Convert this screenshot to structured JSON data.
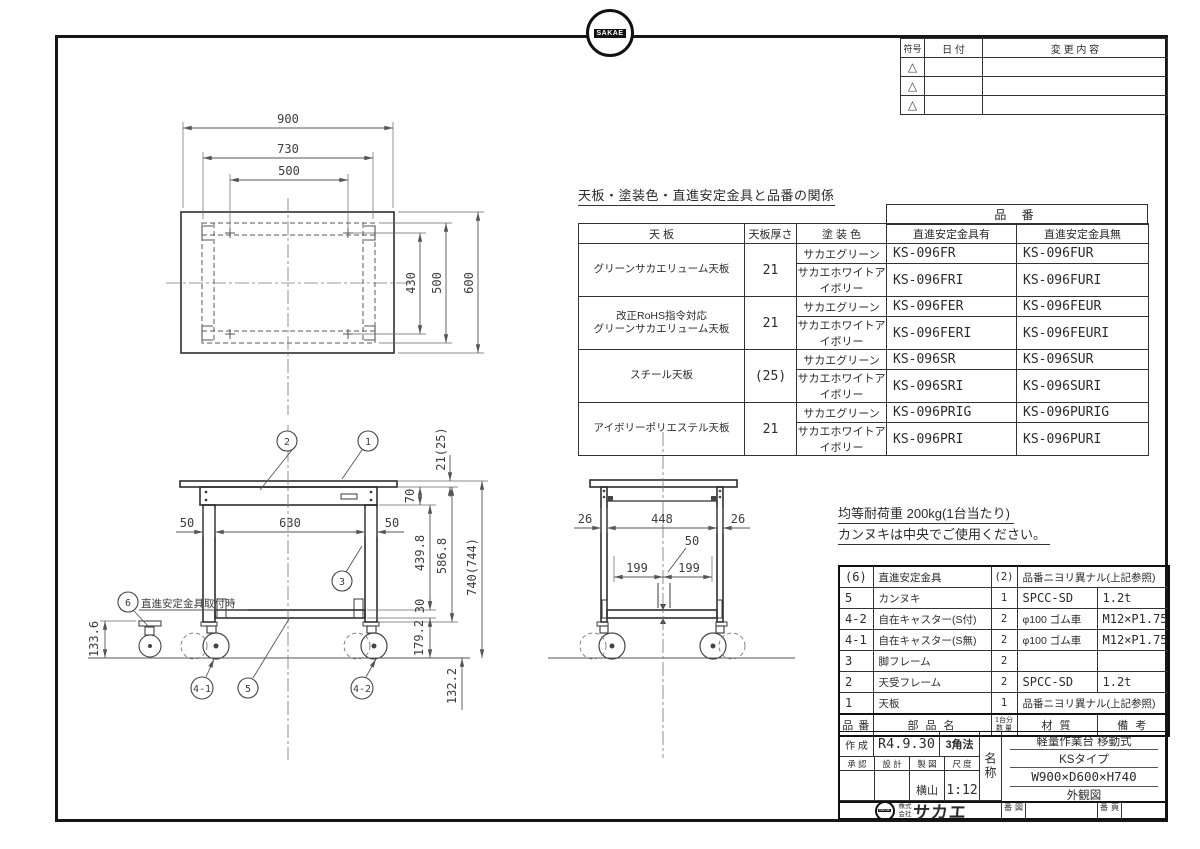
{
  "top_logo": {
    "badge": "SAKAE"
  },
  "revision_table": {
    "headers": {
      "symbol": "符号",
      "date": "日 付",
      "change": "変 更 内 容"
    },
    "rows": [
      {
        "symbol": "△"
      },
      {
        "symbol": "△"
      },
      {
        "symbol": "△"
      }
    ]
  },
  "product_table": {
    "title": "天板・塗装色・直進安定金具と品番の関係",
    "part_no_header": "品 番",
    "col_headers": {
      "panel": "天 板",
      "thickness": "天板厚さ",
      "color": "塗 装 色",
      "with_fitting": "直進安定金具有",
      "without_fitting": "直進安定金具無"
    },
    "rows": [
      {
        "panel": "グリーンサカエリューム天板",
        "thickness": "21",
        "colors": [
          {
            "name": "サカエグリーン",
            "with_no": "KS-096FR",
            "without_no": "KS-096FUR"
          },
          {
            "name": "サカエホワイトアイボリー",
            "with_no": "KS-096FRI",
            "without_no": "KS-096FURI"
          }
        ]
      },
      {
        "panel": "改正RoHS指令対応\nグリーンサカエリューム天板",
        "thickness": "21",
        "colors": [
          {
            "name": "サカエグリーン",
            "with_no": "KS-096FER",
            "without_no": "KS-096FEUR"
          },
          {
            "name": "サカエホワイトアイボリー",
            "with_no": "KS-096FERI",
            "without_no": "KS-096FEURI"
          }
        ]
      },
      {
        "panel": "スチール天板",
        "thickness": "(25)",
        "colors": [
          {
            "name": "サカエグリーン",
            "with_no": "KS-096SR",
            "without_no": "KS-096SUR"
          },
          {
            "name": "サカエホワイトアイボリー",
            "with_no": "KS-096SRI",
            "without_no": "KS-096SURI"
          }
        ]
      },
      {
        "panel": "アイボリーポリエステル天板",
        "thickness": "21",
        "colors": [
          {
            "name": "サカエグリーン",
            "with_no": "KS-096PRIG",
            "without_no": "KS-096PURIG"
          },
          {
            "name": "サカエホワイトアイボリー",
            "with_no": "KS-096PRI",
            "without_no": "KS-096PURI"
          }
        ]
      }
    ]
  },
  "notes": {
    "load": "均等耐荷重 200kg(1台当たり)",
    "kannuki": "カンヌキは中央でご使用ください。"
  },
  "parts_table": {
    "headers": {
      "no": "品 番",
      "name": "部 品 名",
      "qty_line1": "1台分",
      "qty_line2": "数 量",
      "material": "材  質",
      "remark": "備  考"
    },
    "rows": [
      {
        "no": "(6)",
        "name": "直進安定金具",
        "qty": "(2)",
        "material": "品番ニヨリ異ナル(上記参照)",
        "remark": ""
      },
      {
        "no": "5",
        "name": "カンヌキ",
        "qty": "1",
        "material": "SPCC-SD",
        "remark": "1.2t"
      },
      {
        "no": "4-2",
        "name": "自在キャスター(S付)",
        "qty": "2",
        "material": "φ100 ゴム車",
        "remark": "M12×P1.75"
      },
      {
        "no": "4-1",
        "name": "自在キャスター(S無)",
        "qty": "2",
        "material": "φ100 ゴム車",
        "remark": "M12×P1.75"
      },
      {
        "no": "3",
        "name": "脚フレーム",
        "qty": "2",
        "material": "",
        "remark": ""
      },
      {
        "no": "2",
        "name": "天受フレーム",
        "qty": "2",
        "material": "SPCC-SD",
        "remark": "1.2t"
      },
      {
        "no": "1",
        "name": "天板",
        "qty": "1",
        "material": "品番ニヨリ異ナル(上記参照)",
        "remark": ""
      }
    ]
  },
  "title_block": {
    "created_label": "作 成",
    "created_date": "R4.9.30",
    "projection": "3角法",
    "approval_label": "承 認",
    "design_label": "設 計",
    "draft_label": "製 図",
    "scale_label": "尺 度",
    "draft_value": "横山",
    "scale_value": "1:12",
    "name_label": "名称",
    "name_lines": [
      "軽量作業台 移動式",
      "KSタイプ",
      "W900×D600×H740",
      "外観図"
    ],
    "company_prefix": "株式会社",
    "company_name": "サカエ",
    "company_badge": "SAKAE",
    "drawing_no_label": "図番",
    "page_no_label": "頁番"
  },
  "drawing": {
    "top_view": {
      "d900": "900",
      "d730": "730",
      "d500_top": "500",
      "d430": "430",
      "d500_right": "500",
      "d600": "600"
    },
    "front_view": {
      "d21_25": "21(25)",
      "d70": "70",
      "d50_left": "50",
      "d630": "630",
      "d50_right": "50",
      "d439_8": "439.8",
      "d586_8": "586.8",
      "d740_744": "740(744)",
      "d30": "30",
      "d179_2": "179.2",
      "d133_6": "133.6",
      "d132_2": "132.2"
    },
    "side_view": {
      "d26_left": "26",
      "d448": "448",
      "d26_right": "26",
      "d50_center": "50",
      "d199_left": "199",
      "d199_right": "199"
    },
    "callouts": {
      "c1": "1",
      "c2": "2",
      "c3": "3",
      "c4_1": "4-1",
      "c4_2": "4-2",
      "c5": "5",
      "c6": "6",
      "c6_note": "直進安定金具取付時"
    }
  }
}
